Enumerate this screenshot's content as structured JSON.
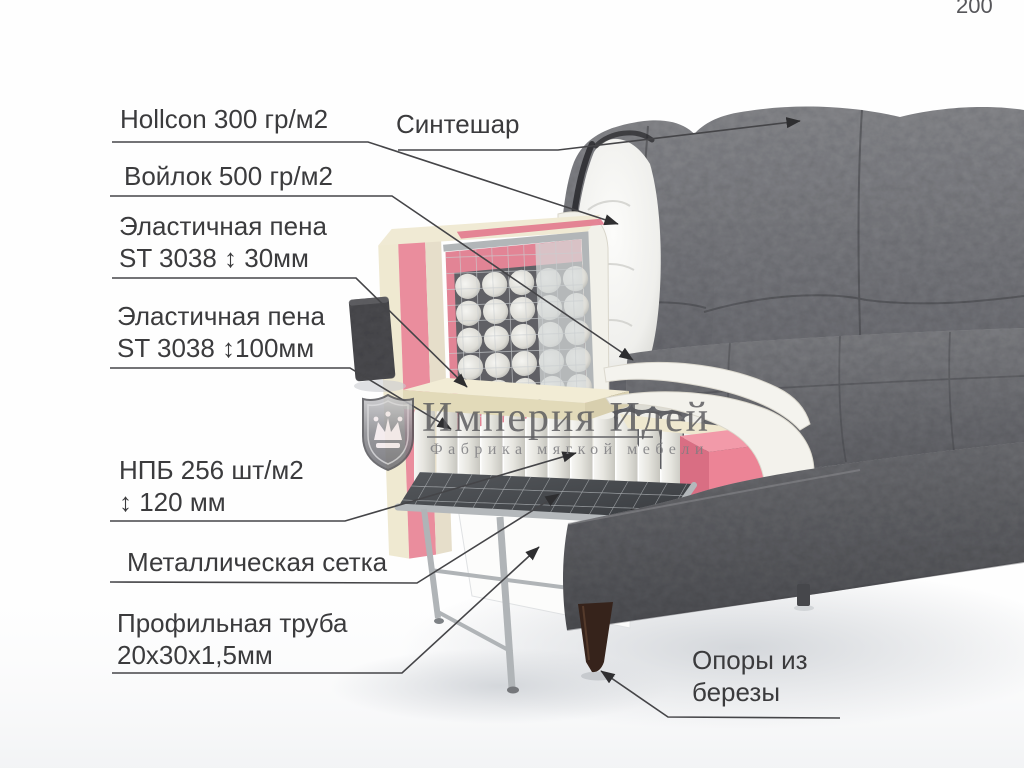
{
  "page_number": "200",
  "watermark": {
    "brand": "Империя Идей",
    "tagline": "Фабрика мягкой мебели",
    "logo_icon": "crown-shield-icon"
  },
  "annotations": {
    "hollcon": {
      "line1": "Hollcon 300 гр/м2"
    },
    "sinteshar": {
      "line1": "Синтешар"
    },
    "felt": {
      "line1": "Войлок 500 гр/м2"
    },
    "foam30": {
      "line1": "Эластичная пена",
      "line2": "ST 3038 ↕ 30мм"
    },
    "foam100": {
      "line1": "Эластичная пена",
      "line2": "ST 3038 ↕100мм"
    },
    "springs": {
      "line1": "НПБ 256 шт/м2",
      "line2": "↕ 120 мм"
    },
    "mesh": {
      "line1": "Металлическая сетка"
    },
    "tube": {
      "line1": "Профильная труба",
      "line2": "20х30х1,5мм"
    },
    "supports": {
      "line1": "Опоры из",
      "line2": "березы"
    }
  },
  "colors": {
    "foam_pink": "#ea8d9d",
    "foam_cream": "#efe9d1",
    "fabric_gray": "#6f7074",
    "metal_gray": "#b4b8bb",
    "wood_leg": "#36231b",
    "annotation_line": "#454548"
  }
}
